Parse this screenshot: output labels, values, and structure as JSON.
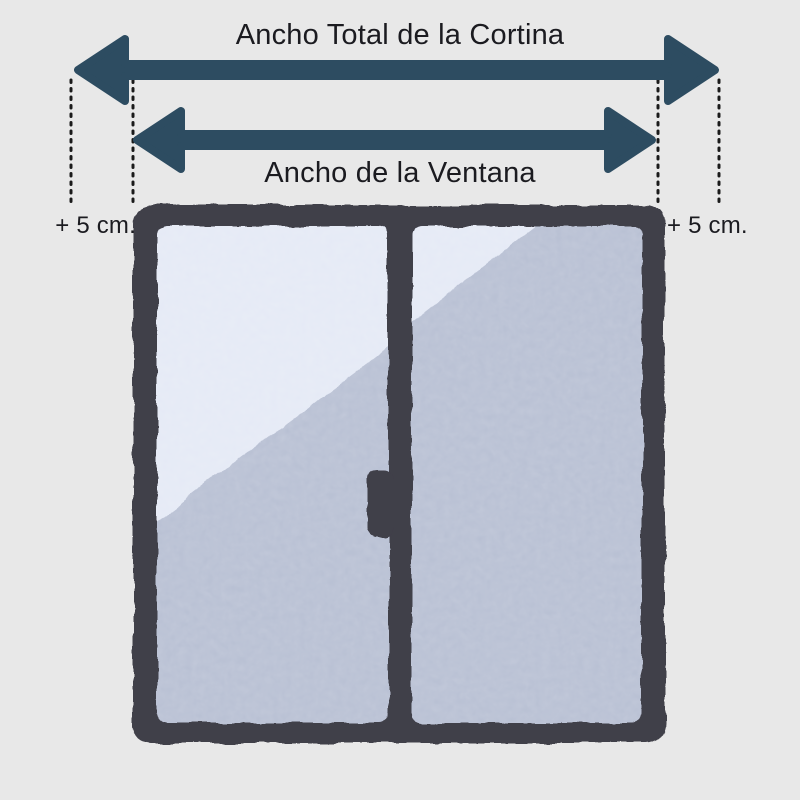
{
  "diagram": {
    "curtain_width_label": "Ancho Total de la Cortina",
    "window_width_label": "Ancho de la Ventana",
    "left_margin_label": "+ 5 cm.",
    "right_margin_label": "+ 5 cm."
  },
  "icons": {
    "curtain_width_arrow": "double-headed-horizontal-arrow",
    "window_width_arrow": "double-headed-horizontal-arrow",
    "window": "two-pane-sliding-window-illustration"
  },
  "colors": {
    "background": "#e8e8e8",
    "arrow": "#2d4c61",
    "text": "#1b1b20",
    "dotted_line": "#1a1a1a",
    "window_frame": "#403f49",
    "glass": "#b6bed2",
    "glass_highlight": "#e4e9f5"
  }
}
